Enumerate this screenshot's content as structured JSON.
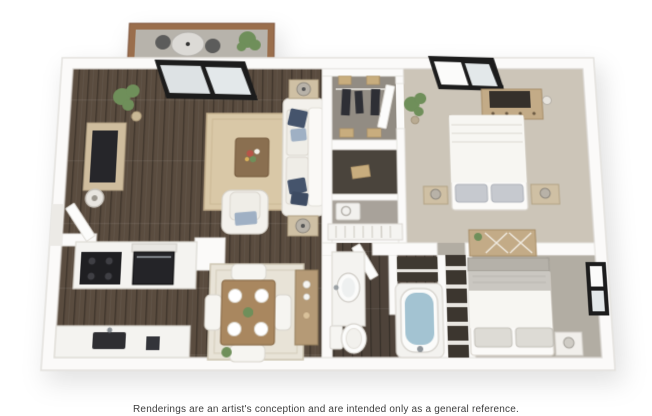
{
  "disclaimer": "Renderings are an artist's conception and are intended only as a general reference.",
  "floorplan": {
    "style": "3D top-down rendering",
    "rooms": [
      "balcony",
      "living room",
      "kitchen",
      "dining area",
      "hallway",
      "closets",
      "laundry nook",
      "bedroom 1",
      "bedroom 2",
      "bathroom",
      "linen closet"
    ]
  },
  "colors": {
    "background": "#ffffff",
    "wall": "#fbfaf9",
    "wall_edge": "#e7e5e1",
    "wood_floor": "#5a4c3f",
    "wood_floor_dark": "#46392e",
    "bath_floor": "#4e433a",
    "carpet_hall_bed1": "#ccc5b8",
    "carpet_bed2": "#b2ada3",
    "living_rug": "#d9c8a7",
    "dining_rug": "#e8e3d7",
    "sofa_white": "#f3f1ec",
    "cushion": "#efede7",
    "pillow_navy": "#45546c",
    "pillow_stripe": "#9fb0c4",
    "wood_furniture": "#c3ab87",
    "wood_side_table": "#cfc0a4",
    "dining_table_wood": "#a9875f",
    "console_wood": "#b59a76",
    "coffee_table_wood": "#8a6f50",
    "tv_dark": "#26262a",
    "appliance_black": "#1f1f22",
    "counter_white": "#f4f3f0",
    "tub_water": "#a3c3d2",
    "plant_green": "#6f8f5a",
    "balcony_rail": "#9a6e4c",
    "balcony_floor": "#b7b3ab",
    "window_frame": "#1c1c1c",
    "glass": "#e3e8ea",
    "closet_dark": "#3c362f",
    "closet_floor": "#928c83",
    "text": "#3d3d3d"
  }
}
